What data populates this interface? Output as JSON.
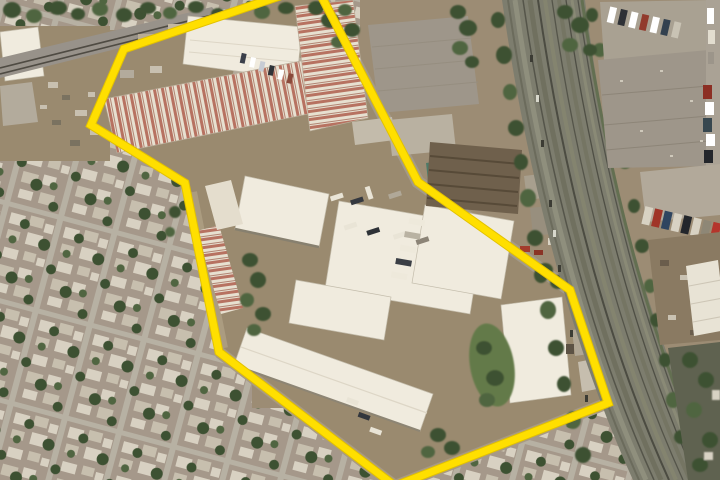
{
  "meta": {
    "type": "aerial-satellite-photo",
    "description": "Aerial satellite view of an industrial warehouse complex outlined by a yellow boundary polygon; dense residential neighborhood to the west, a multi-track rail and highway corridor to the east, truck yards and gray warehouses beyond the corridor.",
    "width_px": 720,
    "height_px": 480
  },
  "overlay": {
    "boundary": {
      "color": "#ffdf00",
      "underlay_color": "#e2c100",
      "stroke_width": 7,
      "points": "315,-16 124,49 91,125 185,183 219,352 395,486 608,403 570,290 418,182"
    }
  },
  "palette": {
    "ground": "#9c8c74",
    "industrial_dirt": "#9a8a6f",
    "residential_ground": "#a5988a",
    "residential_house_light": "#d8d1c2",
    "residential_house_dark": "#c7bfae",
    "residential_street": "#b7b1a3",
    "tree_dark": "#3d5132",
    "tree_mid": "#506541",
    "grass": "#647a4a",
    "warehouse_white": "#f0ebde",
    "warehouse_gray": "#9e968a",
    "rust_base": "#e7e0d0",
    "rust_streak": "#ab5645",
    "corridor_base": "#7d7d6e",
    "corridor_dark": "#55554a",
    "corridor_light": "#8f8f7d",
    "concrete": "#b2a99a",
    "rail_gravel": "#98928a"
  }
}
